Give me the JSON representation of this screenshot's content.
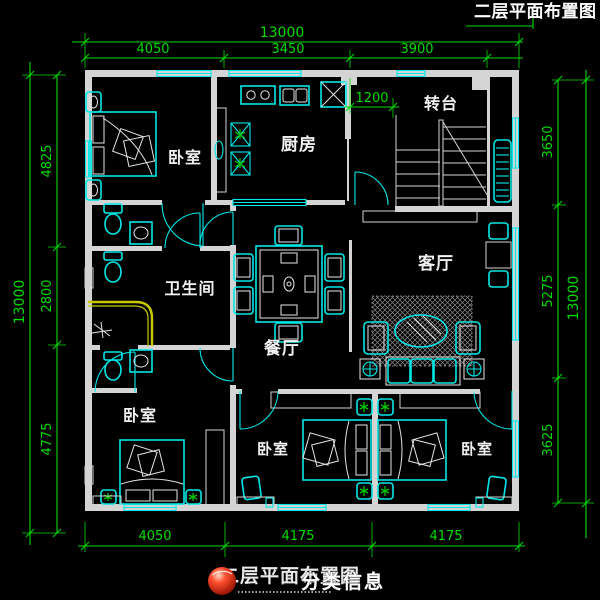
{
  "drawing": {
    "title_top_right": "二层平面布置图",
    "title_bottom": "二层平面布置图"
  },
  "watermark": {
    "text": "分类信息"
  },
  "rooms": {
    "bedroom_top_left": "卧室",
    "kitchen": "厨房",
    "stair_landing": "转台",
    "bathroom": "卫生间",
    "dining": "餐厅",
    "living": "客厅",
    "bedroom_bottom_left": "卧室",
    "bedroom_bottom_middle": "卧室",
    "bedroom_bottom_right": "卧室"
  },
  "dimensions": {
    "top": {
      "total": "13000",
      "segments": [
        "4050",
        "3450",
        "3900"
      ]
    },
    "left": {
      "total": "13000",
      "segments": [
        "4825",
        "2800",
        "4775"
      ]
    },
    "right": {
      "total": "13000",
      "segments": [
        "3650",
        "5275",
        "3625"
      ]
    },
    "bottom": {
      "segments": [
        "4050",
        "4175",
        "4175"
      ]
    },
    "interior": {
      "corridor": "1200"
    }
  },
  "colors": {
    "bg": "#000000",
    "wall": "#d4d4d4",
    "fixture": "#00e8e8",
    "dim": "#00dc00",
    "label": "#f2f2f2",
    "accent": "#c8c800",
    "plant": "#00c800",
    "watermark_red": "#cc2200"
  }
}
